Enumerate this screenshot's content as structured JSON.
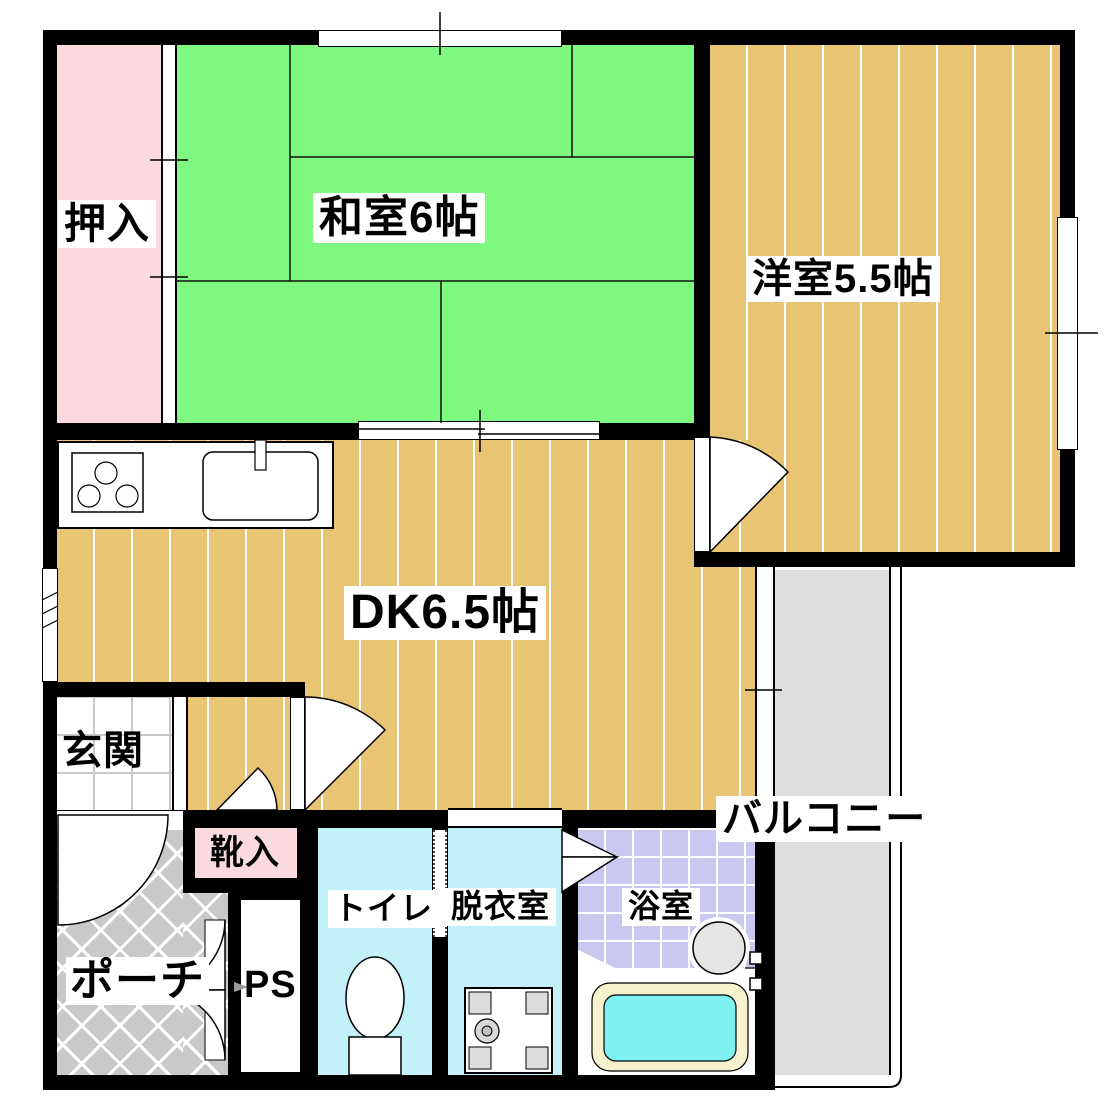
{
  "plan_title": "1DK apartment floor plan",
  "colors": {
    "wall": "#000000",
    "tatami_green": "#7EF87E",
    "closet_pink": "#FADADF",
    "flooring_tan": "#E8C474",
    "wet_room_cyan": "#C2F1F9",
    "bath_lavender": "#C8C8F0",
    "porch_gray": "#C9C9C9",
    "balcony_gray": "#DEDEDE",
    "tub_water": "#7DF0F2",
    "tub_rim": "#F7F2CE",
    "heater_gray": "#E5E5E5",
    "washer_pad_gray": "#DCDCDC",
    "genkan_tile_line": "#C9C9C9"
  },
  "rooms": {
    "oshiire": {
      "label": "押入"
    },
    "washitsu": {
      "label": "和室6帖"
    },
    "youshitsu": {
      "label": "洋室5.5帖"
    },
    "dk": {
      "label": "DK6.5帖"
    },
    "genkan": {
      "label": "玄関"
    },
    "kutsuire": {
      "label": "靴入"
    },
    "toilet": {
      "label": "トイレ"
    },
    "datsuishitsu": {
      "label": "脱衣室"
    },
    "yokushitsu": {
      "label": "浴室"
    },
    "balcony": {
      "label": "バルコニー"
    },
    "porch": {
      "label": "ポーチ"
    },
    "ps": {
      "label": "PS"
    }
  }
}
